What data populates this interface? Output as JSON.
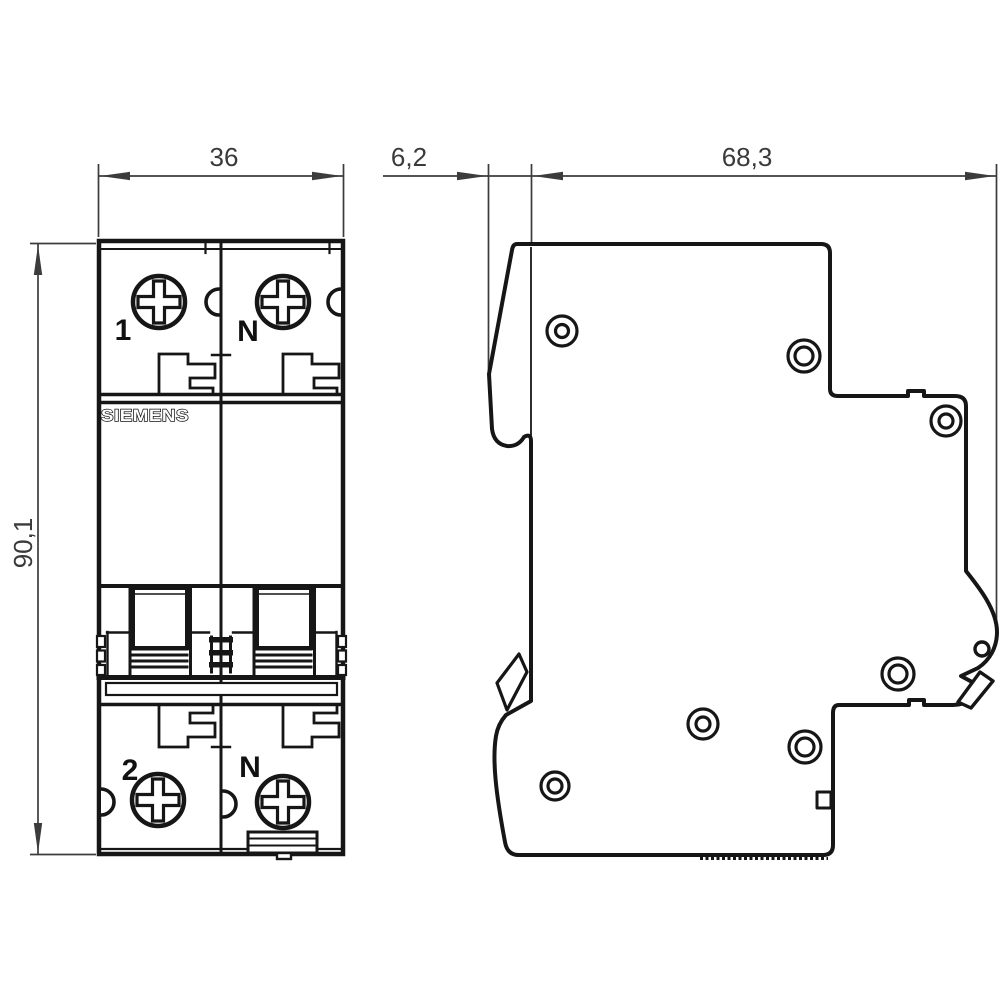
{
  "drawing": {
    "type": "technical-dimension-drawing",
    "subject": "miniature circuit breaker, front and side view",
    "dimensions": {
      "front_width": "36",
      "front_protrusion_depth": "6,2",
      "body_depth": "68,3",
      "height": "90,1"
    },
    "front_view": {
      "brand": "SIEMENS",
      "terminal_labels": {
        "top_left": "1",
        "top_right": "N",
        "bottom_left": "2",
        "bottom_right": "N"
      }
    },
    "colors": {
      "body_line": "#161616",
      "dimension_line": "#3a3a3a",
      "background": "#ffffff"
    }
  }
}
